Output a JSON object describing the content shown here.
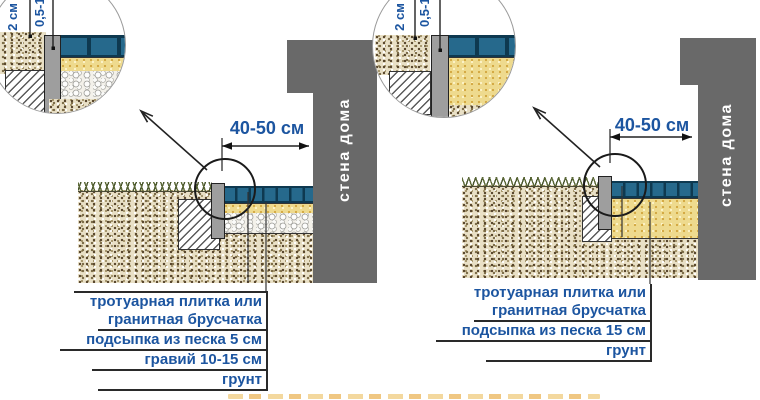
{
  "colors": {
    "label_text": "#1c55a0",
    "wall_fill": "#696969",
    "wall_text": "#ffffff",
    "tile_fill": "#26698c",
    "sand_fill": "#eeda8e",
    "caption_fragment": "#e7a93f"
  },
  "left_diagram": {
    "inset_dims": {
      "a": "2 см",
      "b": "0,5-1 см"
    },
    "width_dimension": "40-50 см",
    "wall_label": "стена дома",
    "callouts": [
      "тротуарная плитка или",
      "гранитная брусчатка",
      "подсыпка из песка 5 см",
      "гравий 10-15 см",
      "грунт"
    ]
  },
  "right_diagram": {
    "inset_dims": {
      "a": "2 см",
      "b": "0,5-1 см"
    },
    "width_dimension": "40-50 см",
    "wall_label": "стена дома",
    "callouts": [
      "тротуарная плитка или",
      "гранитная брусчатка",
      "подсыпка из песка 15 см",
      "грунт"
    ]
  }
}
